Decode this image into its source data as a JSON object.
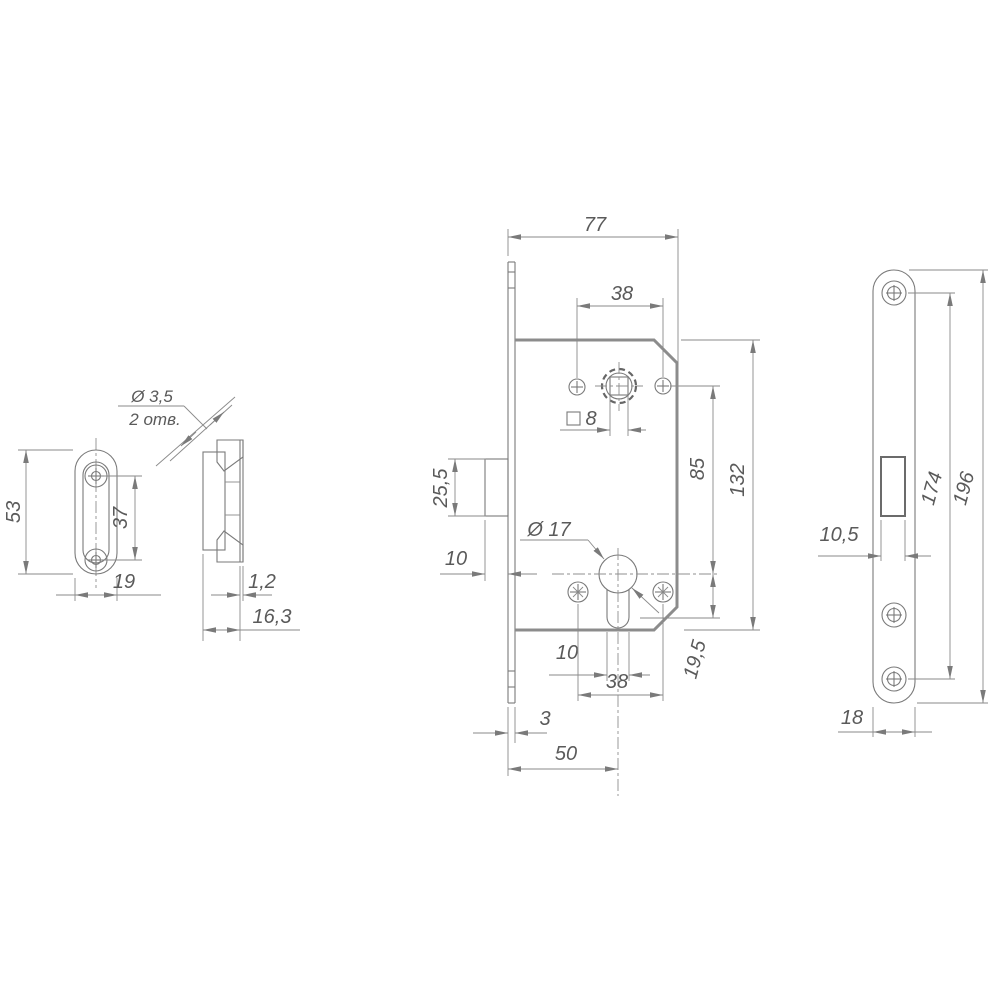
{
  "page": {
    "background": "#ffffff"
  },
  "colors": {
    "line": "#7a7a7a",
    "body_outline": "#8c8c8c",
    "text": "#5a5a5a"
  },
  "views": {
    "strike_front": {
      "name": "strike plate front view",
      "dim_height": "53",
      "dim_hole_spacing": "37",
      "dim_width": "19"
    },
    "strike_section": {
      "name": "strike plate section view",
      "callout_diameter": "Ø 3,5",
      "callout_qty": "2 отв.",
      "dim_thickness": "1,2",
      "dim_depth": "16,3"
    },
    "lock_body": {
      "name": "lock body view",
      "dim_width": "77",
      "dim_top_holes": "38",
      "dim_square": "8",
      "dim_latch_height": "25,5",
      "dim_latch_protrusion": "10",
      "cylinder_callout": "Ø 17",
      "dim_spindle_to_cylinder": "85",
      "dim_height": "132",
      "dim_stem_width": "10",
      "dim_bottom_holes": "38",
      "dim_cylinder_tail": "19,5",
      "dim_faceplate_thickness": "3",
      "dim_backset": "50"
    },
    "faceplate": {
      "name": "faceplate front view",
      "dim_screw_spacing": "174",
      "dim_height": "196",
      "dim_cutout_width": "10,5",
      "dim_width": "18"
    }
  }
}
